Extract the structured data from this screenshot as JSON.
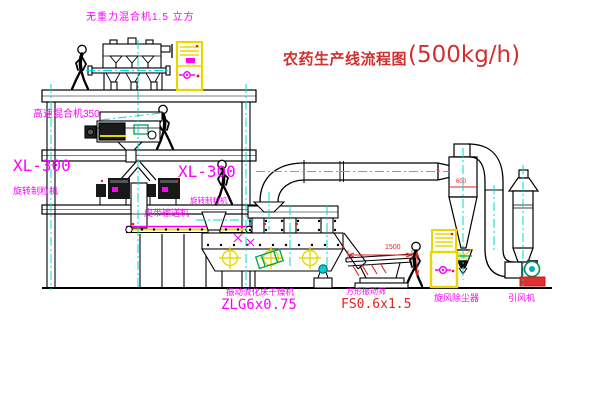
{
  "title": {
    "name": "农药生产线流程图",
    "capacity": "(500kg/h)"
  },
  "labels": {
    "gravity_free_mixer": "无重力混合机1.5 立方",
    "high_speed_mixer": "高速混合机350",
    "granulator_left_model": "XL-300",
    "granulator_left_name": "旋转制粒机",
    "granulator_right_model": "XL-300",
    "granulator_right_name": "旋转制粒机",
    "belt_conveyor": "皮带输送机",
    "dryer_name": "振动流化床干燥机",
    "dryer_model": "ZLG6x0.75",
    "sieve_name": "方形振动筛",
    "sieve_model": "FS0.6x1.5",
    "cyclone": "旋风除尘器",
    "fan": "引风机"
  },
  "dimensions": {
    "sieve_length": "1500",
    "cyclone_marker": "600"
  },
  "colors": {
    "label_magenta": "#FF00FF",
    "dimension_red": "#FF0000",
    "title_red": "#D03030",
    "centerline_cyan": "#00DBDB",
    "cabinet_yellow": "#E8D800",
    "machine_green": "#00A050"
  }
}
